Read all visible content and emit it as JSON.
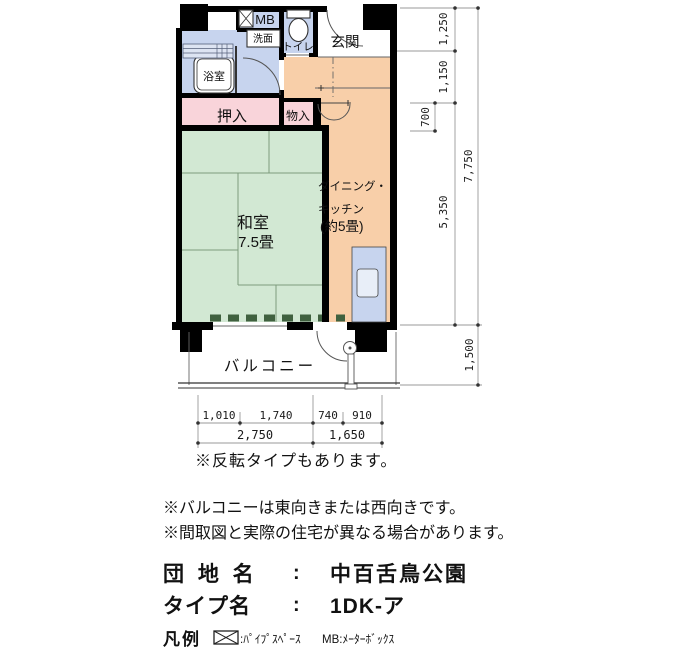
{
  "plan": {
    "room_labels": {
      "mb": "MB",
      "washstand": "洗面",
      "toilet": "トイレ",
      "entrance": "玄関",
      "bath": "浴室",
      "oshiire": "押入",
      "monoire": "物入",
      "washitsu": "和室",
      "washitsu_size": "7.5畳",
      "dk_line1": "ダイニング・",
      "dk_line2": "キッチン",
      "dk_line3": "(約5畳)",
      "balcony": "バルコニー"
    },
    "dimensions_right": {
      "seg_1250": "1,250",
      "seg_1150": "1,150",
      "seg_700": "700",
      "seg_5350": "5,350",
      "total_7750": "7,750",
      "balcony_1500": "1,500"
    },
    "dimensions_bottom": {
      "seg_1010": "1,010",
      "seg_1740": "1,740",
      "seg_740": "740",
      "seg_910": "910",
      "total_2750": "2,750",
      "total_1650": "1,650"
    }
  },
  "notes": {
    "reverse_type": "※反転タイプもあります。",
    "balcony_facing": "※バルコニーは東向きまたは西向きです。",
    "disclaimer": "※間取図と実際の住宅が異なる場合があります。"
  },
  "property": {
    "estate_label": "団 地 名",
    "estate_colon": ":",
    "estate_name": "中百舌鳥公園",
    "type_label": "タイプ名",
    "type_colon": ":",
    "type_name": "1DK-ア"
  },
  "legend": {
    "title": "凡例",
    "pipe_space": ":ﾊﾟｲﾌﾟｽﾍﾟｰｽ",
    "meter_box": "MB:ﾒｰﾀｰﾎﾞｯｸｽ"
  },
  "colors": {
    "water_blue": "#c7d4ee",
    "dk_orange": "#f8cfa9",
    "tatami_green": "#d2e8d3",
    "closet_pink": "#f9d4da",
    "wall_black": "#000000",
    "tatami_sill_green": "#40613f"
  }
}
